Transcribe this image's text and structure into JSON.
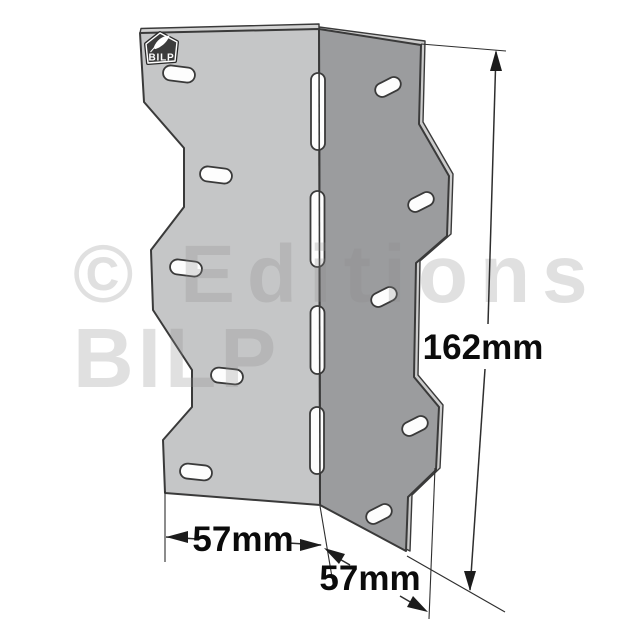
{
  "watermark": {
    "line1": "© Editions",
    "line2": "BILP"
  },
  "logo": {
    "label": "BILP"
  },
  "dimensions": {
    "height": "162mm",
    "flange_left": "57mm",
    "flange_right": "57mm"
  },
  "colors": {
    "background": "#ffffff",
    "left_face": "#c5c6c7",
    "right_face": "#9b9c9e",
    "edge_highlight": "#cbcbcb",
    "top_edge_highlight": "#d2d2d2",
    "outline": "#3a3a3a",
    "slot_fill": "#fdfdfd",
    "dim_line": "#2e2e2e",
    "dim_text": "#0b0b0b",
    "watermark": "#8c8c8c",
    "badge_fill": "#3c3c3c",
    "badge_text": "#ffffff"
  }
}
